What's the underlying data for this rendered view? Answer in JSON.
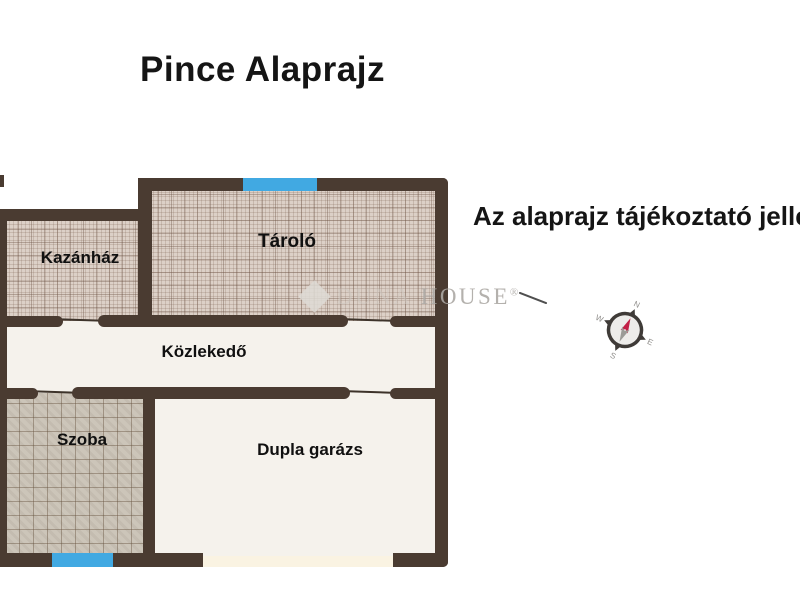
{
  "title": "Pince Alaprajz",
  "disclaimer": "Az alaprajz tájékoztató jellegű",
  "watermark": {
    "part1": "DUNA",
    "part2": "HOUSE",
    "registered": "®"
  },
  "rooms": [
    {
      "id": "kazanhaz",
      "label": "Kazánház"
    },
    {
      "id": "tarolo",
      "label": "Tároló"
    },
    {
      "id": "kozlekedo",
      "label": "Közlekedő"
    },
    {
      "id": "szoba",
      "label": "Szoba"
    },
    {
      "id": "dupla-garazs",
      "label": "Dupla garázs"
    }
  ],
  "compass": {
    "n": "N",
    "e": "E",
    "s": "S",
    "w": "W",
    "rotation_deg": 25
  },
  "colors": {
    "wall": "#4a3b31",
    "window": "#41a9e2",
    "hatch_fine_bg": "#dcd0c7",
    "hatch_coarse_bg": "#ccc5b9",
    "room_white": "#f5f2ec",
    "garage_door_strip": "#faf3e2",
    "needle_north": "#c22047",
    "needle_south": "#9b9b97"
  }
}
